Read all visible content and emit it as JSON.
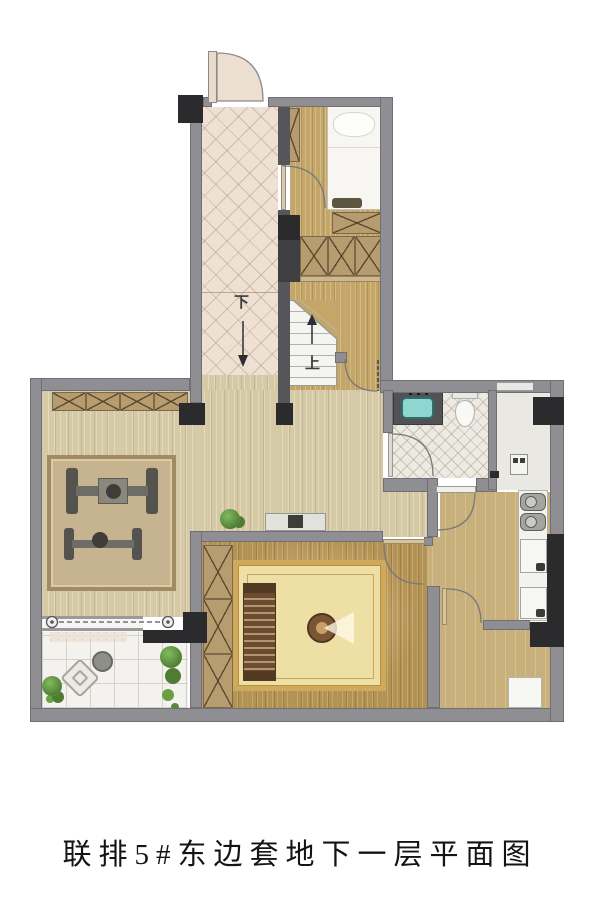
{
  "caption": "联排5#东边套地下一层平面图",
  "stair_labels": {
    "down": "下",
    "up": "上"
  },
  "palette": {
    "wall_gray": "#8e8e93",
    "wall_dark": "#55555a",
    "structure_black": "#2b2b2d",
    "corridor_hatch": "#eee1d4",
    "wood_light": "#d5c9a6",
    "wood_gold": "#c3a668",
    "wood_hall": "#c9b07a",
    "wood_room": "#b49254",
    "bathroom_tile": "#eceae2",
    "terrace_tile": "#f3f2ee",
    "rug_living": "#c6b390",
    "rug_room_field": "#eedfa4",
    "rug_room_border": "#cfa95c",
    "basin_teal": "#8fd6d0",
    "plant_green": "#5f9440",
    "bed_white": "#f7f6f2"
  }
}
